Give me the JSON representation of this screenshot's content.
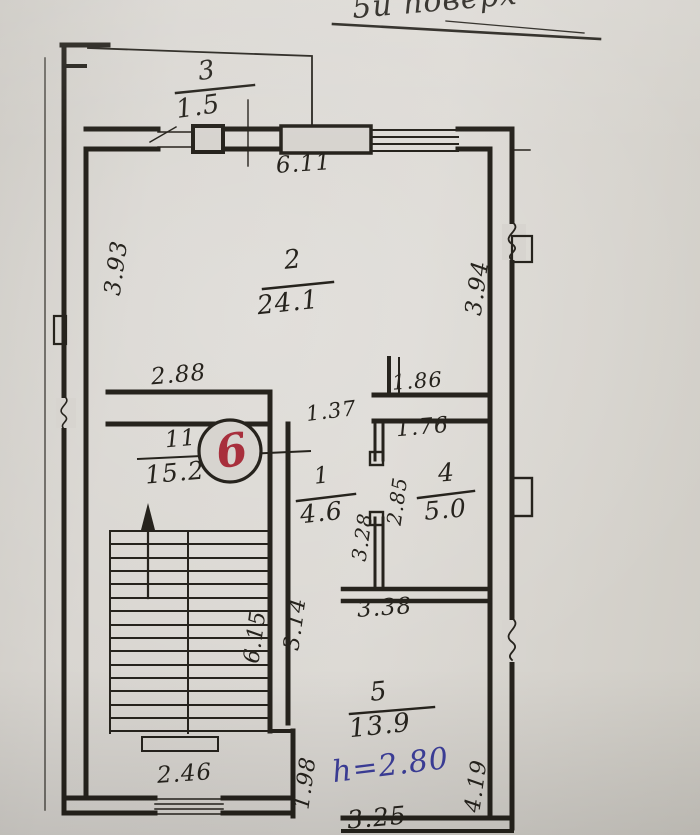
{
  "title": "5й поверх",
  "apartment": {
    "number": "6"
  },
  "rooms": {
    "balcony": {
      "num": "3",
      "area": "1.5"
    },
    "living": {
      "num": "2",
      "area": "24.1"
    },
    "stair_hall": {
      "num": "11",
      "tilde": "~",
      "area": "15.2"
    },
    "corridor": {
      "num": "1",
      "area": "4.6"
    },
    "kitchen": {
      "num": "4",
      "area": "5.0"
    },
    "room5": {
      "num": "5",
      "area": "13.9"
    }
  },
  "dimensions": {
    "top_window": "6.11",
    "room2_left": "3.93",
    "room2_right": "3.94",
    "hall_top": "2.88",
    "room4_top": "1.86",
    "passage": "1.37",
    "room4_inner": "1.76",
    "partition_left": "3.28",
    "partition_right": "2.85",
    "room5_top": "3.38",
    "stair_run": "6.15",
    "stair_wall": "3.14",
    "hall_window": "2.46",
    "room5_left": "1.98",
    "room5_right": "4.19",
    "room5_bottom": "3.25"
  },
  "notes": {
    "ceiling_height": "h=2.80"
  },
  "colors": {
    "ink": "#26231d",
    "accent_red": "#a82f3c",
    "accent_blue": "#3d3f9c",
    "paper": "#d7d4cf"
  }
}
